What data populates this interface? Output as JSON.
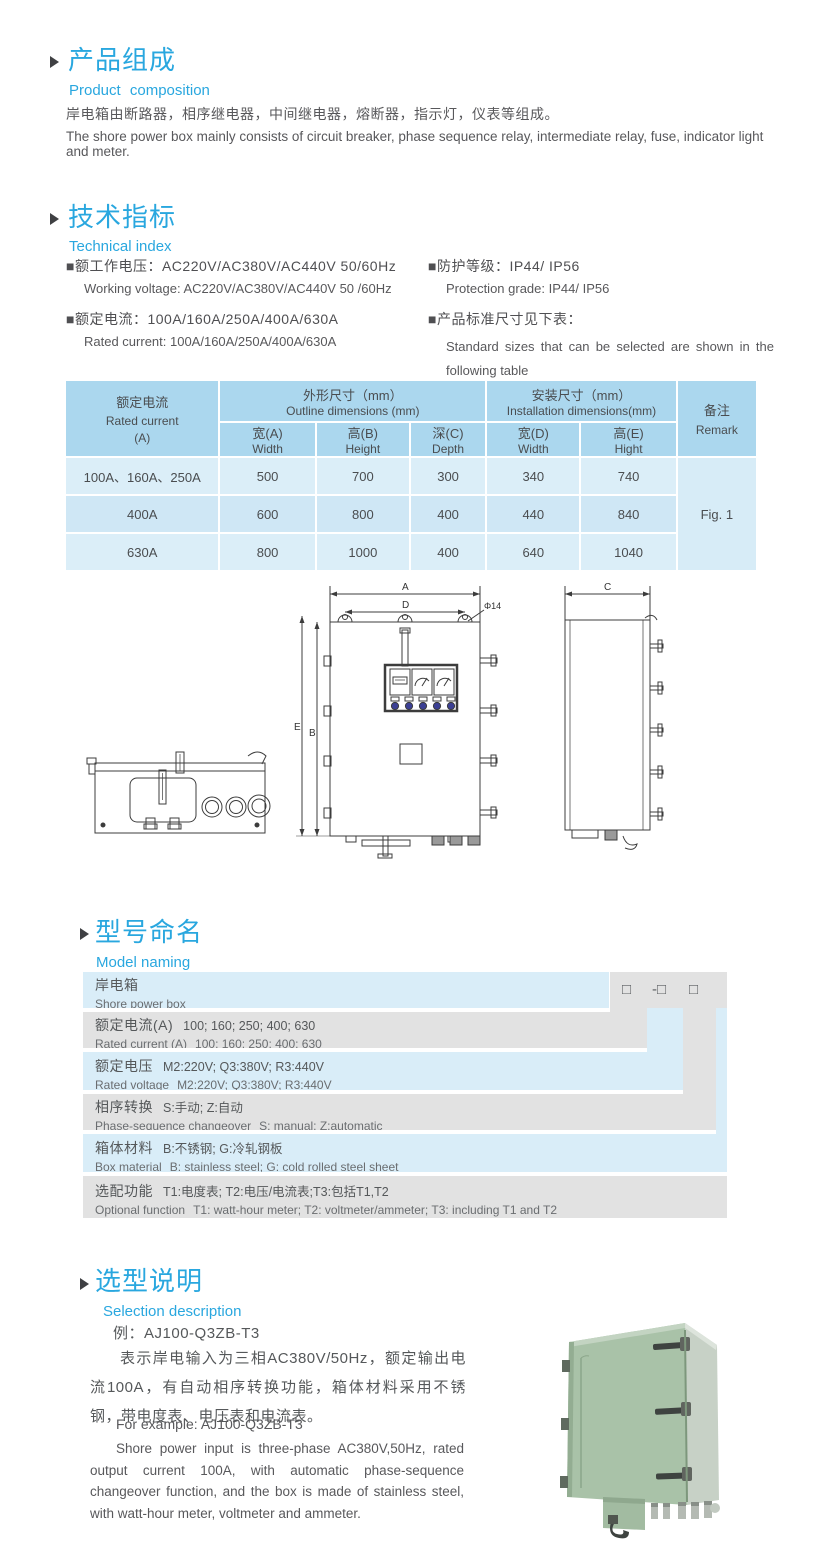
{
  "accent_color": "#29a7df",
  "table_header_color": "#abd7ee",
  "composition": {
    "title_cn": "产品组成",
    "title_en": "Product composition",
    "body_cn": "岸电箱由断路器，相序继电器，中间继电器，熔断器，指示灯，仪表等组成。",
    "body_en": "The shore power box mainly consists of circuit breaker, phase sequence relay, intermediate relay, fuse, indicator light and meter."
  },
  "technical": {
    "title_cn": "技术指标",
    "title_en": "Technical index",
    "specs": [
      {
        "cn": "■额工作电压：AC220V/AC380V/AC440V  50/60Hz",
        "en": "Working voltage: AC220V/AC380V/AC440V 50 /60Hz"
      },
      {
        "cn": "■额定电流：100A/160A/250A/400A/630A",
        "en": "Rated current: 100A/160A/250A/400A/630A"
      },
      {
        "cn": "■防护等级：IP44/ IP56",
        "en": "Protection grade: IP44/ IP56"
      },
      {
        "cn": "■产品标准尺寸见下表：",
        "en": "Standard sizes that can be selected are shown in the following table"
      }
    ]
  },
  "dim_table": {
    "col1_cn": "额定电流",
    "col1_en": "Rated current",
    "col1_unit": "(A)",
    "outline_cn": "外形尺寸（mm）",
    "outline_en": "Outline dimensions (mm)",
    "install_cn": "安装尺寸（mm）",
    "install_en": "Installation dimensions(mm)",
    "remark_cn": "备注",
    "remark_en": "Remark",
    "sub": [
      {
        "cn": "宽(A)",
        "en": "Width"
      },
      {
        "cn": "高(B)",
        "en": "Height"
      },
      {
        "cn": "深(C)",
        "en": "Depth"
      },
      {
        "cn": "宽(D)",
        "en": "Width"
      },
      {
        "cn": "高(E)",
        "en": "Hight"
      }
    ],
    "rows": [
      {
        "current": "100A、160A、250A",
        "w": "500",
        "h": "700",
        "d": "300",
        "iw": "340",
        "ih": "740"
      },
      {
        "current": "400A",
        "w": "600",
        "h": "800",
        "d": "400",
        "iw": "440",
        "ih": "840"
      },
      {
        "current": "630A",
        "w": "800",
        "h": "1000",
        "d": "400",
        "iw": "640",
        "ih": "1040"
      }
    ],
    "remark_value": "Fig. 1"
  },
  "drawing": {
    "dim_a": "A",
    "dim_d": "D",
    "dim_phi": "Φ14",
    "dim_e": "E",
    "dim_b": "B",
    "dim_c": "C"
  },
  "naming": {
    "title_cn": "型号命名",
    "title_en": "Model naming",
    "code_prefix": "AJ",
    "sym1": "□",
    "sym2": "-□",
    "sym3": "□",
    "row1": {
      "cn": "岸电箱",
      "en": "Shore power box"
    },
    "rows": [
      {
        "cn_label": "额定电流(A)",
        "cn_value": "100; 160; 250; 400; 630",
        "en_label": "Rated current (A)",
        "en_value": "100; 160; 250; 400; 630"
      },
      {
        "cn_label": "额定电压",
        "cn_value": "M2:220V;  Q3:380V;  R3:440V",
        "en_label": "Rated voltage",
        "en_value": "M2:220V;  Q3:380V;  R3:440V"
      },
      {
        "cn_label": "相序转换",
        "cn_value": "S:手动; Z:自动",
        "en_label": "Phase-sequence changeover",
        "en_value": "S: manual;  Z:automatic"
      },
      {
        "cn_label": "箱体材料",
        "cn_value": "B:不锈钢;  G:冷轧钢板",
        "en_label": "Box material",
        "en_value": "B: stainless steel; G: cold rolled steel sheet"
      },
      {
        "cn_label": "选配功能",
        "cn_value": "T1:电度表;  T2:电压/电流表;T3:包括T1,T2",
        "en_label": "Optional function",
        "en_value": "T1: watt-hour meter; T2: voltmeter/ammeter; T3: including T1 and T2"
      }
    ]
  },
  "selection": {
    "title_cn": "选型说明",
    "title_en": "Selection description",
    "example_cn": "例：AJ100-Q3ZB-T3",
    "desc_cn": "表示岸电输入为三相AC380V/50Hz，额定输出电流100A，有自动相序转换功能，箱体材料采用不锈钢，带电度表、电压表和电流表。",
    "example_en": "For example: AJ100-Q3ZB-T3",
    "desc_en": "Shore power input is three-phase AC380V,50Hz, rated output current 100A, with automatic phase-sequence changeover function, and the box is made of stainless steel, with watt-hour meter, voltmeter and ammeter."
  }
}
